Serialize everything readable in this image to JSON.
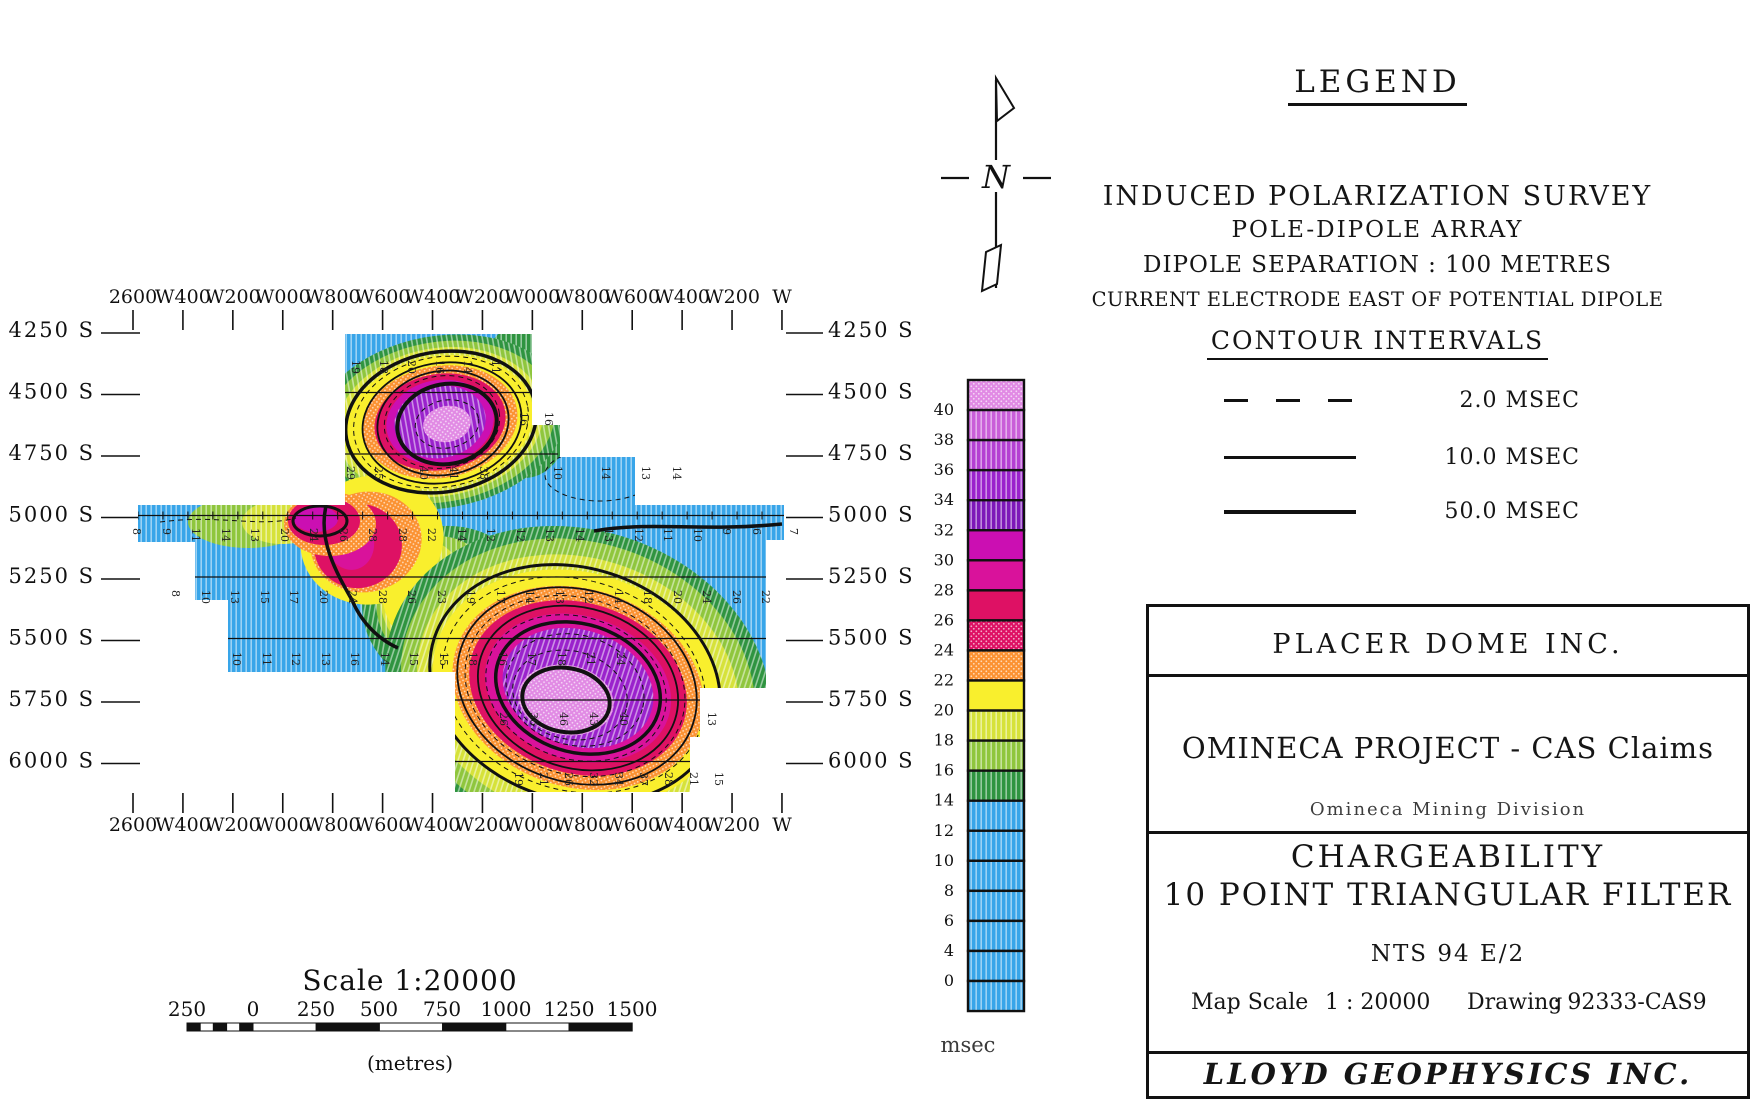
{
  "map": {
    "top_axis_labels": [
      "2600",
      "W400",
      "W200",
      "W000",
      "W800",
      "W600",
      "W400",
      "W200",
      "W000",
      "W800",
      "W600",
      "W400",
      "W200",
      "W"
    ],
    "bottom_axis_labels": [
      "2600",
      "W400",
      "W200",
      "W000",
      "W800",
      "W600",
      "W400",
      "W200",
      "W000",
      "W800",
      "W600",
      "W400",
      "W200",
      "W"
    ],
    "left_axis_labels": [
      "4250 S",
      "4500 S",
      "4750 S",
      "5000 S",
      "5250 S",
      "5500 S",
      "5750 S",
      "6000 S"
    ],
    "right_axis_labels": [
      "4250 S",
      "4500 S",
      "4750 S",
      "5000 S",
      "5250 S",
      "5500 S",
      "5750 S",
      "6000 S"
    ],
    "station_rows": [
      {
        "y": 360,
        "items": [
          {
            "x": 352,
            "v": "19"
          },
          {
            "x": 380,
            "v": "18"
          },
          {
            "x": 408,
            "v": "20"
          },
          {
            "x": 436,
            "v": "16"
          },
          {
            "x": 464,
            "v": "14"
          },
          {
            "x": 492,
            "v": "11"
          }
        ]
      },
      {
        "y": 412,
        "items": [
          {
            "x": 520,
            "v": "16"
          },
          {
            "x": 545,
            "v": "16"
          }
        ]
      },
      {
        "y": 466,
        "items": [
          {
            "x": 347,
            "v": "29"
          },
          {
            "x": 375,
            "v": "25"
          },
          {
            "x": 420,
            "v": "40"
          },
          {
            "x": 450,
            "v": "41"
          },
          {
            "x": 480,
            "v": "38"
          },
          {
            "x": 554,
            "v": "10"
          },
          {
            "x": 602,
            "v": "14"
          },
          {
            "x": 642,
            "v": "13"
          },
          {
            "x": 673,
            "v": "14"
          }
        ]
      },
      {
        "y": 528,
        "items": [
          {
            "x": 133,
            "v": "8"
          },
          {
            "x": 163,
            "v": "9"
          },
          {
            "x": 192,
            "v": "11"
          },
          {
            "x": 222,
            "v": "14"
          },
          {
            "x": 251,
            "v": "13"
          },
          {
            "x": 281,
            "v": "20"
          },
          {
            "x": 310,
            "v": "24"
          },
          {
            "x": 340,
            "v": "26"
          },
          {
            "x": 369,
            "v": "28"
          },
          {
            "x": 399,
            "v": "28"
          },
          {
            "x": 428,
            "v": "22"
          },
          {
            "x": 458,
            "v": "14"
          },
          {
            "x": 487,
            "v": "12"
          },
          {
            "x": 517,
            "v": "12"
          },
          {
            "x": 546,
            "v": "13"
          },
          {
            "x": 576,
            "v": "14"
          },
          {
            "x": 605,
            "v": "13"
          },
          {
            "x": 635,
            "v": "12"
          },
          {
            "x": 664,
            "v": "11"
          },
          {
            "x": 694,
            "v": "10"
          },
          {
            "x": 723,
            "v": "9"
          },
          {
            "x": 753,
            "v": "6"
          },
          {
            "x": 790,
            "v": "7"
          }
        ]
      },
      {
        "y": 590,
        "items": [
          {
            "x": 172,
            "v": "8"
          },
          {
            "x": 202,
            "v": "10"
          },
          {
            "x": 231,
            "v": "13"
          },
          {
            "x": 261,
            "v": "15"
          },
          {
            "x": 290,
            "v": "17"
          },
          {
            "x": 320,
            "v": "20"
          },
          {
            "x": 349,
            "v": "24"
          },
          {
            "x": 379,
            "v": "28"
          },
          {
            "x": 408,
            "v": "26"
          },
          {
            "x": 438,
            "v": "23"
          },
          {
            "x": 467,
            "v": "19"
          },
          {
            "x": 497,
            "v": "17"
          },
          {
            "x": 526,
            "v": "14"
          },
          {
            "x": 556,
            "v": "13"
          },
          {
            "x": 585,
            "v": "12"
          },
          {
            "x": 615,
            "v": "14"
          },
          {
            "x": 644,
            "v": "18"
          },
          {
            "x": 674,
            "v": "20"
          },
          {
            "x": 703,
            "v": "24"
          },
          {
            "x": 733,
            "v": "26"
          },
          {
            "x": 762,
            "v": "22"
          }
        ]
      },
      {
        "y": 652,
        "items": [
          {
            "x": 233,
            "v": "10"
          },
          {
            "x": 263,
            "v": "11"
          },
          {
            "x": 292,
            "v": "12"
          },
          {
            "x": 322,
            "v": "13"
          },
          {
            "x": 351,
            "v": "16"
          },
          {
            "x": 381,
            "v": "14"
          },
          {
            "x": 410,
            "v": "15"
          },
          {
            "x": 440,
            "v": "15"
          },
          {
            "x": 469,
            "v": "18"
          },
          {
            "x": 499,
            "v": "16"
          },
          {
            "x": 528,
            "v": "17"
          },
          {
            "x": 558,
            "v": "18"
          },
          {
            "x": 587,
            "v": "21"
          },
          {
            "x": 617,
            "v": "24"
          }
        ]
      },
      {
        "y": 712,
        "items": [
          {
            "x": 500,
            "v": "26"
          },
          {
            "x": 530,
            "v": "36"
          },
          {
            "x": 560,
            "v": "46"
          },
          {
            "x": 590,
            "v": "43"
          },
          {
            "x": 620,
            "v": "40"
          },
          {
            "x": 708,
            "v": "13"
          }
        ]
      },
      {
        "y": 772,
        "items": [
          {
            "x": 515,
            "v": "19"
          },
          {
            "x": 540,
            "v": "21"
          },
          {
            "x": 565,
            "v": "26"
          },
          {
            "x": 590,
            "v": "32"
          },
          {
            "x": 615,
            "v": "34"
          },
          {
            "x": 640,
            "v": "37"
          },
          {
            "x": 665,
            "v": "28"
          },
          {
            "x": 690,
            "v": "21"
          },
          {
            "x": 715,
            "v": "15"
          }
        ]
      }
    ]
  },
  "colorbar": {
    "unit": "msec",
    "labels": [
      "40",
      "38",
      "36",
      "34",
      "32",
      "30",
      "28",
      "26",
      "24",
      "22",
      "20",
      "18",
      "16",
      "14",
      "12",
      "10",
      "8",
      "6",
      "4",
      "0"
    ],
    "cells": [
      {
        "key": "core",
        "tex": "dot"
      },
      {
        "key": "orchid",
        "tex": "stripe"
      },
      {
        "key": "orchid2",
        "tex": "stripe"
      },
      {
        "key": "purple",
        "tex": "stripe"
      },
      {
        "key": "purple_dark",
        "tex": "stripe"
      },
      {
        "key": "magenta2",
        "tex": "solid"
      },
      {
        "key": "magenta",
        "tex": "solid"
      },
      {
        "key": "crimson",
        "tex": "solid"
      },
      {
        "key": "crimson",
        "tex": "dot"
      },
      {
        "key": "orange",
        "tex": "dot"
      },
      {
        "key": "yellow",
        "tex": "solid"
      },
      {
        "key": "ygreen",
        "tex": "stripe"
      },
      {
        "key": "green",
        "tex": "stripe"
      },
      {
        "key": "green_dark",
        "tex": "stripe"
      },
      {
        "key": "blue",
        "tex": "stripe"
      },
      {
        "key": "blue",
        "tex": "stripe"
      },
      {
        "key": "blue",
        "tex": "stripe"
      },
      {
        "key": "blue",
        "tex": "stripe"
      },
      {
        "key": "blue",
        "tex": "stripe"
      },
      {
        "key": "blue",
        "tex": "stripe"
      },
      {
        "key": "blue",
        "tex": "stripe"
      }
    ]
  },
  "palette": {
    "blue": "#38a5e9",
    "green_dark": "#2f9440",
    "green": "#8fc63d",
    "ygreen": "#d6e23a",
    "yellow": "#f9ef2d",
    "orange": "#fb9232",
    "crimson": "#de1164",
    "magenta": "#d9129b",
    "magenta2": "#cb0fb2",
    "purple": "#9a22cc",
    "purple_dark": "#7d18b8",
    "orchid": "#c95fd8",
    "orchid2": "#b440d2",
    "core": "#e18ae4",
    "ink": "#111111"
  },
  "north_arrow": {
    "label": "N"
  },
  "legend": {
    "title": "LEGEND",
    "line1": "INDUCED POLARIZATION SURVEY",
    "line2": "POLE-DIPOLE ARRAY",
    "line3": "DIPOLE SEPARATION : 100 METRES",
    "line4": "CURRENT ELECTRODE EAST OF POTENTIAL DIPOLE",
    "contour_title": "CONTOUR INTERVALS",
    "intervals": [
      {
        "style": "dashed",
        "label": "2.0 MSEC"
      },
      {
        "style": "thin",
        "label": "10.0 MSEC"
      },
      {
        "style": "thick",
        "label": "50.0 MSEC"
      }
    ]
  },
  "scale_bar": {
    "title": "Scale 1:20000",
    "tick_labels": [
      "250",
      "0",
      "250",
      "500",
      "750",
      "1000",
      "1250",
      "1500"
    ],
    "unit_label": "(metres)"
  },
  "title_block": {
    "company": "PLACER DOME INC.",
    "project": "OMINECA PROJECT - CAS Claims",
    "division": "Omineca Mining Division",
    "map_title_line1": "CHARGEABILITY",
    "map_title_line2": "10 POINT TRIANGULAR FILTER",
    "nts": "NTS 94 E/2",
    "map_scale_label": "Map Scale",
    "map_scale_value": "1 : 20000",
    "drawing_label": "Drawing",
    "drawing_value": ": 92333-CAS9",
    "contractor": "LLOYD GEOPHYSICS INC."
  },
  "chart_data": {
    "type": "heatmap",
    "title": "CHARGEABILITY - 10 POINT TRIANGULAR FILTER",
    "units": "msec",
    "x_axis": [
      "2600W",
      "2400W",
      "2200W",
      "2000W",
      "1800W",
      "1600W",
      "1400W",
      "1200W",
      "1000W",
      "800W",
      "600W",
      "400W",
      "200W",
      "0W"
    ],
    "y_axis": [
      "4250S",
      "4500S",
      "4750S",
      "5000S",
      "5250S",
      "5500S",
      "5750S",
      "6000S"
    ],
    "colorscale_msec_breaks": [
      0,
      4,
      6,
      8,
      10,
      12,
      14,
      16,
      18,
      20,
      22,
      24,
      26,
      28,
      30,
      32,
      34,
      36,
      38,
      40
    ],
    "contour_intervals_msec": [
      2.0,
      10.0,
      50.0
    ],
    "row_readings": {
      "5000S": [
        8,
        9,
        11,
        14,
        13,
        20,
        24,
        26,
        28,
        28,
        22,
        14,
        12,
        12,
        13,
        14,
        13,
        12,
        11,
        10,
        9,
        6,
        7
      ],
      "5250S": [
        8,
        10,
        13,
        15,
        17,
        20,
        24,
        28,
        26,
        23,
        19,
        17,
        14,
        13,
        12,
        14,
        18,
        20,
        24,
        26,
        22
      ],
      "5500S": [
        10,
        11,
        12,
        13,
        16,
        14,
        15,
        15,
        18,
        16,
        17,
        18,
        21,
        24
      ],
      "6000S": [
        19,
        21,
        26,
        32,
        34,
        37,
        28,
        21,
        15
      ]
    }
  }
}
